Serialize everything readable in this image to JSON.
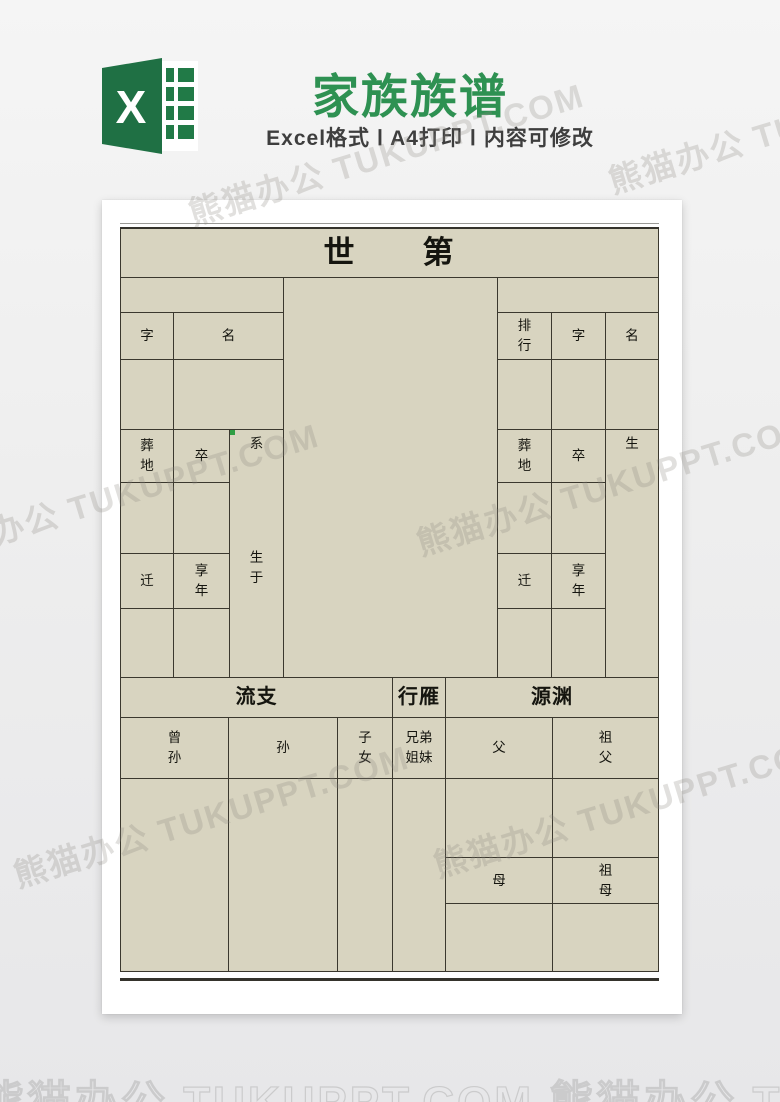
{
  "header": {
    "title": "家族族谱",
    "subtitle": "Excel格式 Ⅰ A4打印 Ⅰ 内容可修改",
    "excel_letter": "X"
  },
  "colors": {
    "brand_green": "#1f7044",
    "title_green": "#2e9152",
    "sheet_beige": "#d8d4c0",
    "grid_line": "#3b382e"
  },
  "watermark": {
    "text": "熊猫办公 TUKUPPT.COM"
  },
  "table": {
    "title": "世　　第",
    "labels": {
      "zi": "字",
      "ming": "名",
      "paihang": "排\n行",
      "zangdi": "葬\n地",
      "zu": "卒",
      "xi": "系",
      "shengyu": "生\n于",
      "sheng": "生",
      "qian": "迁",
      "xiangnian": "享\n年",
      "liuzhi": "流支",
      "xingyan": "行雁",
      "yuanyuan": "源渊",
      "zengsun": "曾\n孙",
      "sun": "孙",
      "zinv": "子\n女",
      "xiongdijiemei": "兄弟\n姐妹",
      "fu": "父",
      "zufu": "祖\n父",
      "mu": "母",
      "zumu": "祖\n母"
    }
  }
}
